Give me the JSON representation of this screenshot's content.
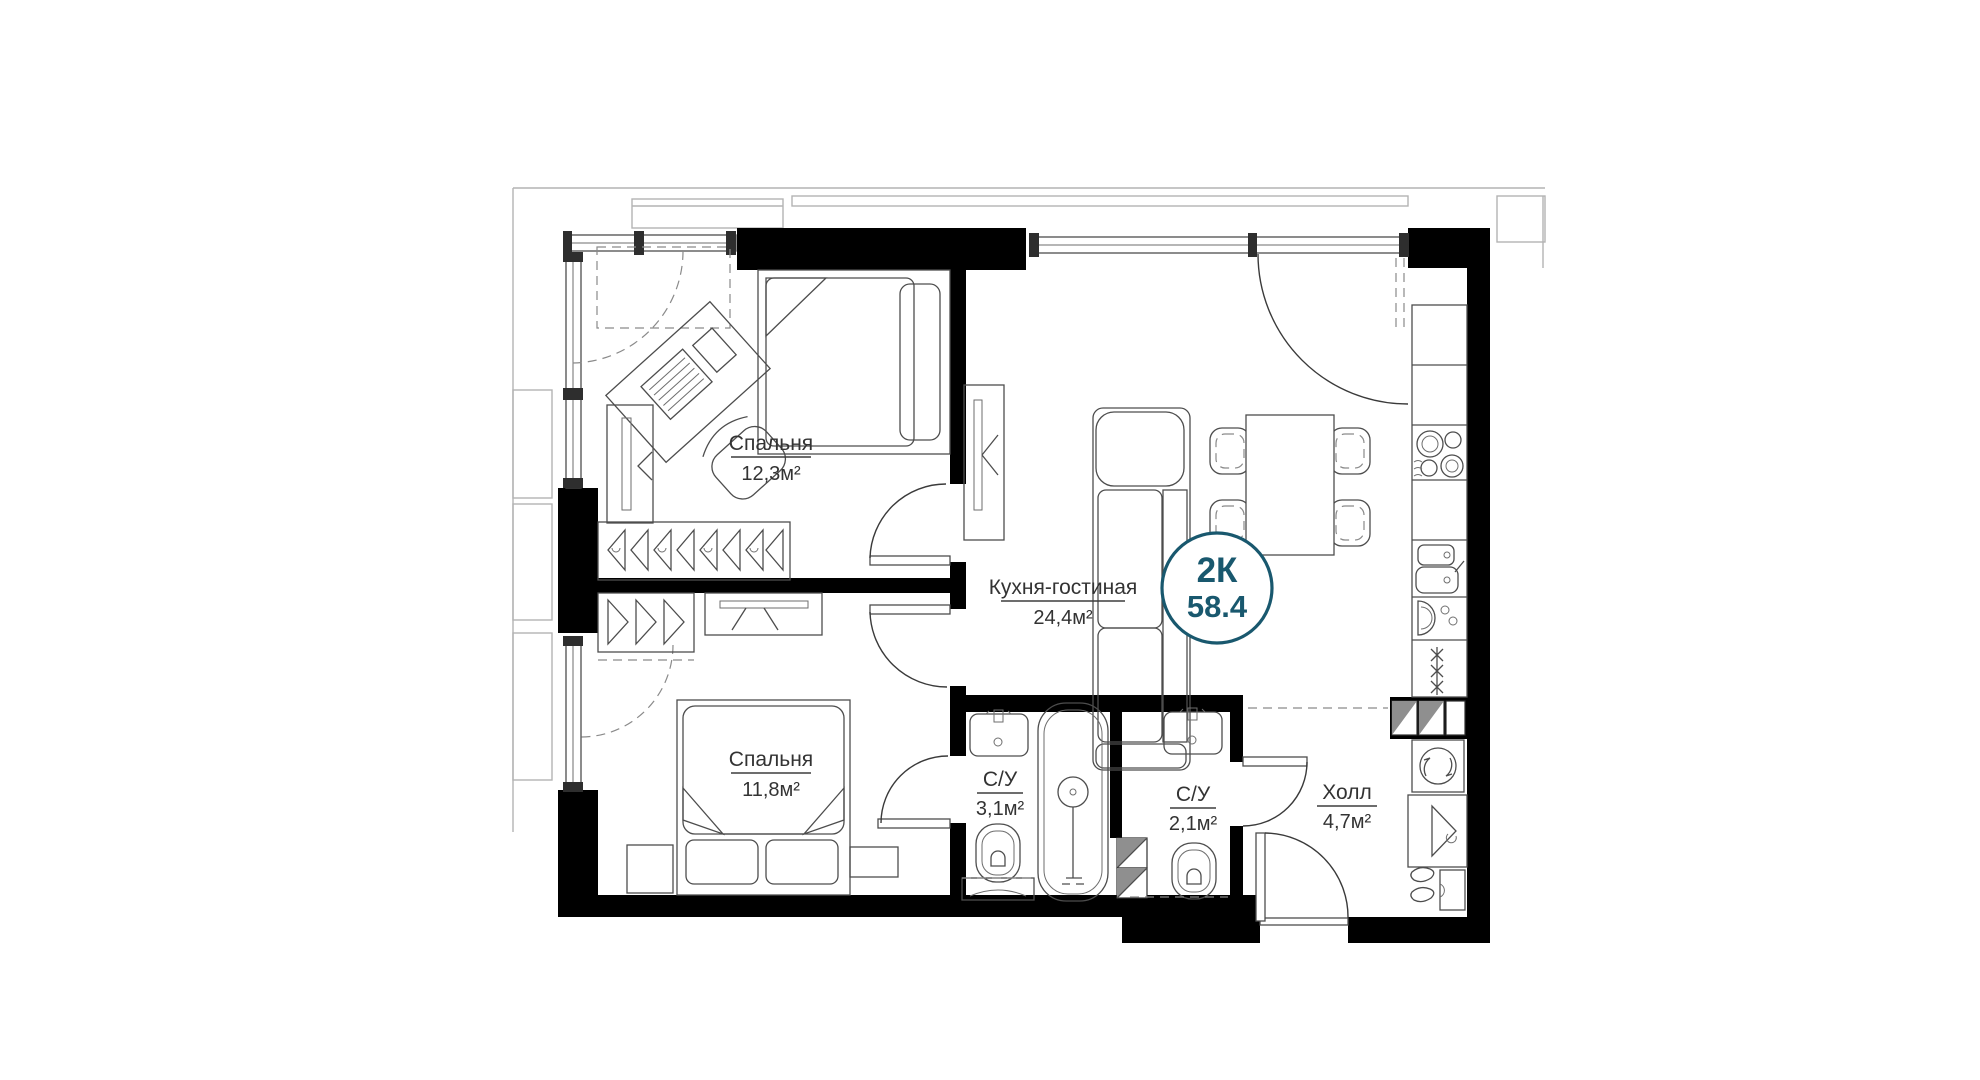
{
  "floorplan": {
    "unit_badge": {
      "label": "2К",
      "value": "58.4"
    },
    "rooms": [
      {
        "name": "Спальня",
        "area": "12,3м²"
      },
      {
        "name": "Спальня",
        "area": "11,8м²"
      },
      {
        "name": "Кухня-гостиная",
        "area": "24,4м²"
      },
      {
        "name": "С/У",
        "area": "3,1м²"
      },
      {
        "name": "С/У",
        "area": "2,1м²"
      },
      {
        "name": "Холл",
        "area": "4,7м²"
      }
    ],
    "colors": {
      "wall": "#000000",
      "furniture_line": "#4d4d4d",
      "facade_line": "#b3b3b3",
      "accent": "#19586e",
      "duct_fill": "#8f8f8f",
      "background": "#ffffff"
    },
    "furniture_icons": [
      "single-bed",
      "double-bed",
      "desk",
      "office-chair",
      "laptop",
      "wardrobe-hangers",
      "mirror-cabinet",
      "tv-stand",
      "nightstand",
      "sofa",
      "dining-table",
      "dining-chair",
      "kitchen-counter",
      "cooktop",
      "kitchen-sink",
      "oven",
      "refrigerator",
      "bathtub",
      "toilet",
      "washbasin",
      "vanity-cabinet",
      "washing-machine",
      "hall-wardrobe",
      "shoes",
      "shoe-cabinet",
      "vent-duct",
      "entrance-door",
      "balcony-door",
      "window"
    ]
  }
}
